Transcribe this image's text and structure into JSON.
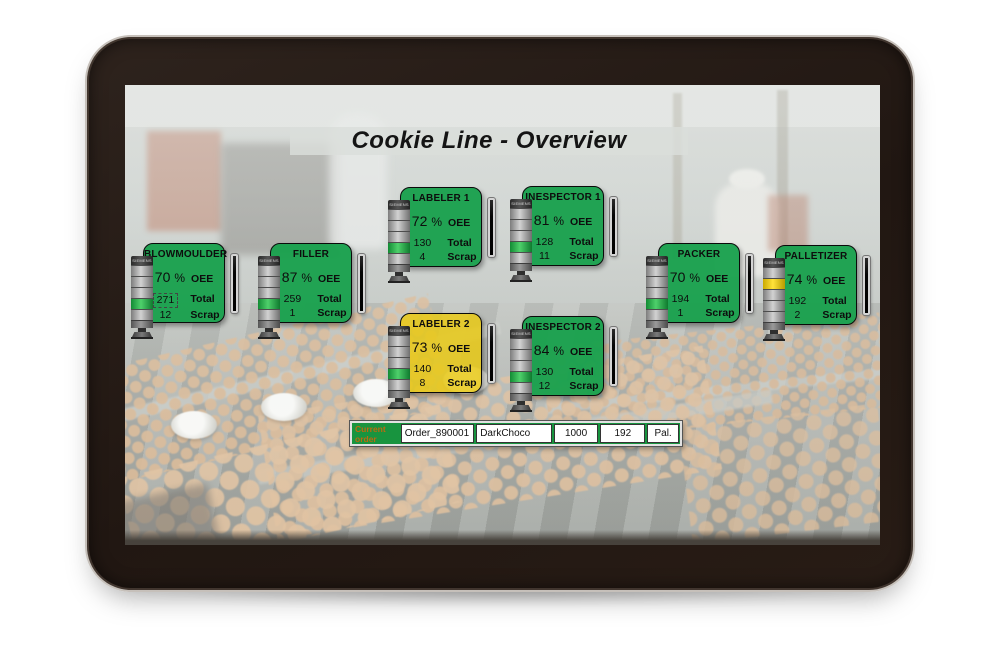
{
  "title": "Cookie Line - Overview",
  "brand_label": "SIEMENS",
  "labels": {
    "oee": "OEE",
    "total": "Total",
    "scrap": "Scrap",
    "percent": "%"
  },
  "colors": {
    "panel_green": "#17a04c",
    "panel_yellow": "#e9c915",
    "light_green": "#2eb04a",
    "light_yellow": "#ffd800",
    "order_frame_green": "#18943f",
    "order_label_text": "#bc6a10"
  },
  "machines": [
    {
      "name": "BLOWMOULDER",
      "oee": "70",
      "total": "271",
      "scrap": "12",
      "panel_color": "#17a04c",
      "light_color": "#2eb04a",
      "total_selected": true
    },
    {
      "name": "FILLER",
      "oee": "87",
      "total": "259",
      "scrap": "1",
      "panel_color": "#17a04c",
      "light_color": "#2eb04a"
    },
    {
      "name": "LABELER 1",
      "oee": "72",
      "total": "130",
      "scrap": "4",
      "panel_color": "#17a04c",
      "light_color": "#2eb04a"
    },
    {
      "name": "INESPECTOR 1",
      "oee": "81",
      "total": "128",
      "scrap": "11",
      "panel_color": "#17a04c",
      "light_color": "#2eb04a"
    },
    {
      "name": "LABELER 2",
      "oee": "73",
      "total": "140",
      "scrap": "8",
      "panel_color": "#e9c915",
      "light_color": "#2eb04a"
    },
    {
      "name": "INESPECTOR 2",
      "oee": "84",
      "total": "130",
      "scrap": "12",
      "panel_color": "#17a04c",
      "light_color": "#2eb04a"
    },
    {
      "name": "PACKER",
      "oee": "70",
      "total": "194",
      "scrap": "1",
      "panel_color": "#17a04c",
      "light_color": "#2eb04a"
    },
    {
      "name": "PALLETIZER",
      "oee": "74",
      "total": "192",
      "scrap": "2",
      "panel_color": "#17a04c",
      "light_color": "#ffd800"
    }
  ],
  "current_order": {
    "label": "Current order",
    "order_id": "Order_890001",
    "product": "DarkChoco",
    "quantity": "1000",
    "produced": "192",
    "unit": "Pal."
  }
}
